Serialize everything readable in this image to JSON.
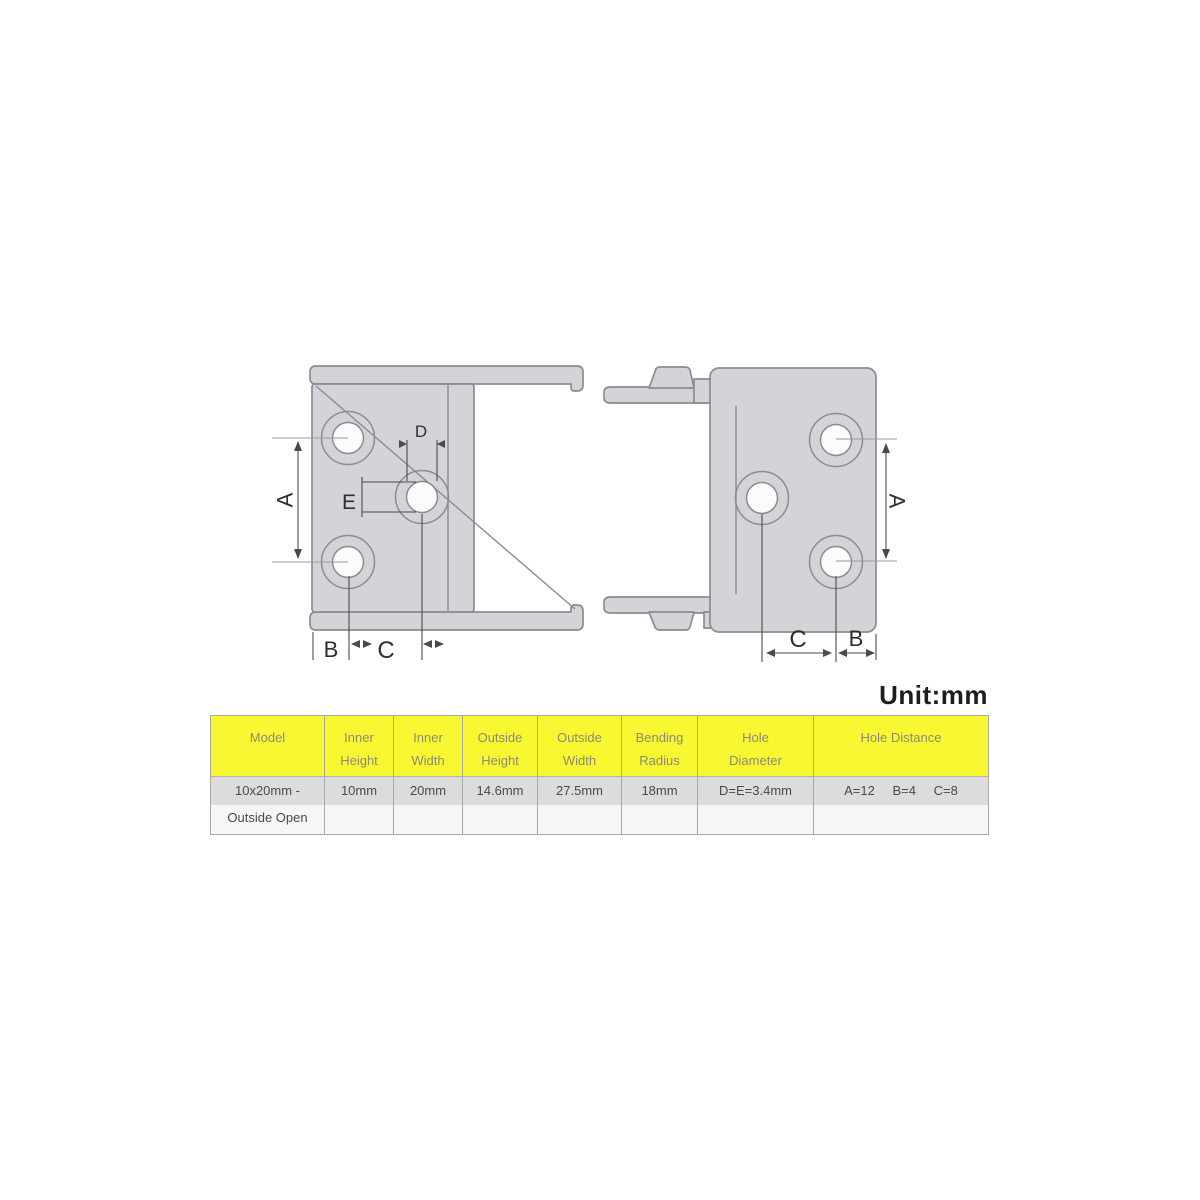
{
  "unit_label": "Unit:mm",
  "drawing": {
    "description": "drag-chain-outside-open-end-connector-dimension-views",
    "left_view_labels": {
      "A": "A",
      "B": "B",
      "C": "C",
      "D": "D",
      "E": "E"
    },
    "right_view_labels": {
      "A": "A",
      "B": "B",
      "C": "C"
    },
    "colors": {
      "part_fill": "#d4d4d8",
      "part_stroke": "#8b8b93",
      "hole_fill": "#fbfbfb",
      "dimension_line": "#4a4a4a",
      "leader_line": "#9a9aa0",
      "label_text": "#2e2e2e"
    }
  },
  "table": {
    "headers": [
      {
        "line1": "Model",
        "line2": ""
      },
      {
        "line1": "Inner",
        "line2": "Height"
      },
      {
        "line1": "Inner",
        "line2": "Width"
      },
      {
        "line1": "Outside",
        "line2": "Height"
      },
      {
        "line1": "Outside",
        "line2": "Width"
      },
      {
        "line1": "Bending",
        "line2": "Radius"
      },
      {
        "line1": "Hole",
        "line2": "Diameter"
      },
      {
        "line1": "Hole Distance",
        "line2": ""
      }
    ],
    "row": {
      "model_line1": "10x20mm -",
      "model_line2": "Outside Open",
      "inner_height": "10mm",
      "inner_width": "20mm",
      "outside_height": "14.6mm",
      "outside_width": "27.5mm",
      "bending_radius": "18mm",
      "hole_diameter": "D=E=3.4mm",
      "hole_distance_a": "A=12",
      "hole_distance_b": "B=4",
      "hole_distance_c": "C=8"
    },
    "colors": {
      "header_bg": "#f8f832",
      "header_text": "#8a8a76",
      "stripe_top": "#dcdcdc",
      "stripe_bottom": "#f6f6f6",
      "border": "#a9a9a9",
      "row_text": "#4a4a4a"
    }
  }
}
